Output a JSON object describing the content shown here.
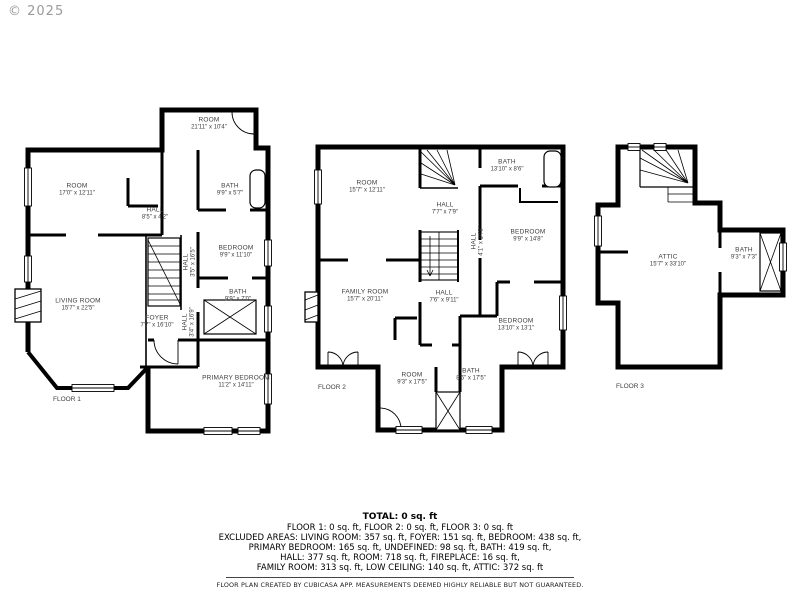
{
  "copyright": "© 2025",
  "floors": [
    {
      "label": "FLOOR 1",
      "rooms": [
        {
          "name": "ROOM",
          "dims": "21'11\" x 10'4\""
        },
        {
          "name": "ROOM",
          "dims": "17'0\" x 12'11\""
        },
        {
          "name": "HALL",
          "dims": "8'5\" x 4'2\""
        },
        {
          "name": "BATH",
          "dims": "9'9\" x 5'7\""
        },
        {
          "name": "BEDROOM",
          "dims": "9'9\" x 11'10\""
        },
        {
          "name": "HALL",
          "dims": "3'5\" x 16'5\""
        },
        {
          "name": "BATH",
          "dims": "9'9\" x 7'0\""
        },
        {
          "name": "LIVING ROOM",
          "dims": "15'7\" x 22'5\""
        },
        {
          "name": "FOYER",
          "dims": "7'7\" x 16'10\""
        },
        {
          "name": "HALL",
          "dims": "3'4\" x 16'9\""
        },
        {
          "name": "PRIMARY BEDROOM",
          "dims": "11'2\" x 14'11\""
        }
      ]
    },
    {
      "label": "FLOOR 2",
      "rooms": [
        {
          "name": "ROOM",
          "dims": "15'7\" x 12'11\""
        },
        {
          "name": "BATH",
          "dims": "13'10\" x 8'6\""
        },
        {
          "name": "HALL",
          "dims": "7'7\" x 7'9\""
        },
        {
          "name": "HALL",
          "dims": "4'1\" x 14'8\""
        },
        {
          "name": "BEDROOM",
          "dims": "9'9\" x 14'8\""
        },
        {
          "name": "FAMILY ROOM",
          "dims": "15'7\" x 20'11\""
        },
        {
          "name": "HALL",
          "dims": "7'6\" x 9'11\""
        },
        {
          "name": "BEDROOM",
          "dims": "13'10\" x 13'1\""
        },
        {
          "name": "ROOM",
          "dims": "9'3\" x 17'5\""
        },
        {
          "name": "BATH",
          "dims": "8'6\" x 17'5\""
        }
      ]
    },
    {
      "label": "FLOOR 3",
      "rooms": [
        {
          "name": "ATTIC",
          "dims": "15'7\" x 33'10\""
        },
        {
          "name": "BATH",
          "dims": "9'3\" x 7'3\""
        }
      ]
    }
  ],
  "summary": {
    "total": "TOTAL: 0 sq. ft",
    "lines": [
      "FLOOR 1: 0 sq. ft, FLOOR 2: 0 sq. ft, FLOOR 3: 0 sq. ft",
      "EXCLUDED AREAS: LIVING ROOM: 357 sq. ft, FOYER: 151 sq. ft, BEDROOM: 438 sq. ft,",
      "PRIMARY BEDROOM: 165 sq. ft, UNDEFINED: 98 sq. ft, BATH: 419 sq. ft,",
      "HALL: 377 sq. ft, ROOM: 718 sq. ft, FIREPLACE: 16 sq. ft,",
      "FAMILY ROOM: 313 sq. ft, LOW CEILING: 140 sq. ft, ATTIC: 372 sq. ft"
    ],
    "disclaimer": "FLOOR PLAN CREATED BY CUBICASA APP. MEASUREMENTS DEEMED HIGHLY RELIABLE BUT NOT GUARANTEED."
  }
}
